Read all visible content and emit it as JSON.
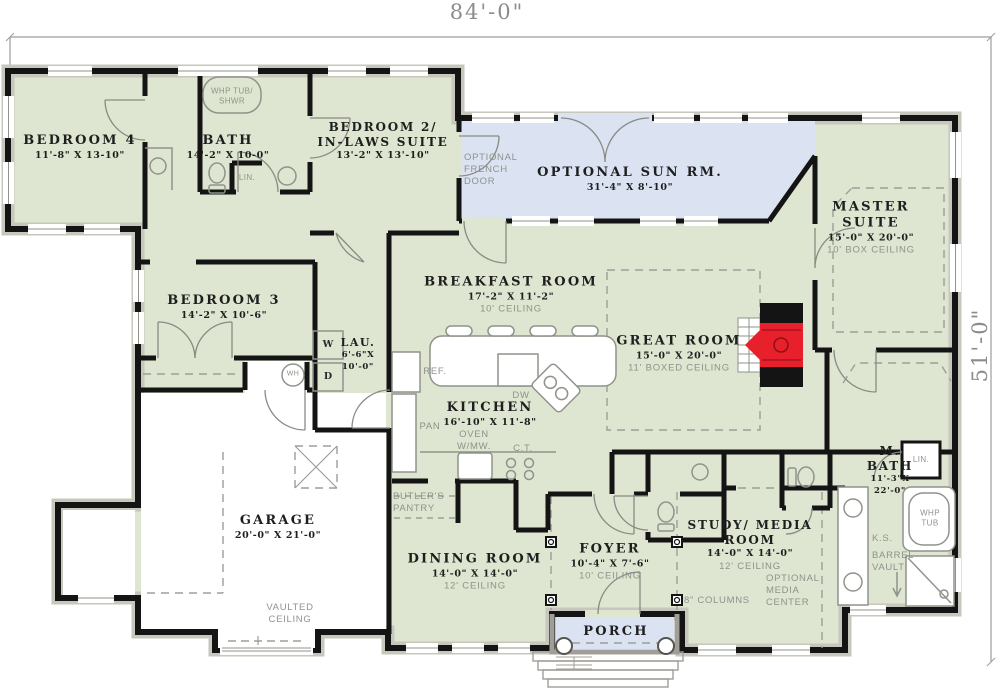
{
  "plan": {
    "dim_top": "84'-0\"",
    "dim_right": "51'-0\"",
    "rooms": {
      "bedroom4": {
        "name": "BEDROOM 4",
        "dims": "11'-8\" X 13-10\""
      },
      "bath": {
        "name": "BATH",
        "dims": "14'-2\" X 10-0\""
      },
      "bedroom2": {
        "name1": "BEDROOM 2/",
        "name2": "IN-LAWS SUITE",
        "dims": "13'-2\" X 13'-10\""
      },
      "sunroom": {
        "name": "OPTIONAL SUN RM.",
        "dims": "31'-4\" X 8'-10\""
      },
      "master": {
        "name1": "MASTER",
        "name2": "SUITE",
        "dims": "15'-0\" X 20'-0\"",
        "ceiling": "10' BOX CEILING"
      },
      "breakfast": {
        "name": "BREAKFAST ROOM",
        "dims": "17'-2\" X 11'-2\"",
        "ceiling": "10' CEILING"
      },
      "greatroom": {
        "name": "GREAT ROOM",
        "dims": "15'-0\" X 20'-0\"",
        "ceiling": "11' BOXED CEILING"
      },
      "bedroom3": {
        "name": "BEDROOM 3",
        "dims": "14'-2\" X 10'-6\""
      },
      "laundry": {
        "name": "LAU.",
        "dims1": "6'-6\"X",
        "dims2": "10'-0\""
      },
      "kitchen": {
        "name": "KITCHEN",
        "dims": "16'-10\" X 11'-8\""
      },
      "garage": {
        "name": "GARAGE",
        "dims": "20'-0\" X 21'-0\""
      },
      "dining": {
        "name": "DINING ROOM",
        "dims": "14'-0\" X 14'-0\"",
        "ceiling": "12' CEILING"
      },
      "foyer": {
        "name": "FOYER",
        "dims": "10'-4\" X 7'-6\"",
        "ceiling": "10' CEILING"
      },
      "study": {
        "name1": "STUDY/ MEDIA",
        "name2": "ROOM",
        "dims": "14'-0\" X 14'-0\"",
        "ceiling": "12' CEILING"
      },
      "mbath": {
        "name1": "M.",
        "name2": "BATH",
        "dims1": "11'-3\"X",
        "dims2": "22'-0\""
      },
      "porch": {
        "name": "PORCH"
      }
    },
    "labels": {
      "whp_shwr1": "WHP TUB/",
      "whp_shwr2": "SHWR",
      "lin_bath": "LIN.",
      "french1": "OPTIONAL",
      "french2": "FRENCH",
      "french3": "DOOR",
      "ref": "REF.",
      "pan": "PAN",
      "dw": "DW",
      "oven1": "OVEN",
      "oven2": "W/MW.",
      "ct": "C.T.",
      "butlers1": "BUTLER'S",
      "butlers2": "PANTRY",
      "vaulted1": "VAULTED",
      "vaulted2": "CEILING",
      "washer": "W",
      "dryer": "D",
      "water_heater": "WH",
      "columns": "8\" COLUMNS",
      "media1": "OPTIONAL",
      "media2": "MEDIA",
      "media3": "CENTER",
      "ks": "K.S.",
      "barrel1": "BARREL",
      "barrel2": "VAULT",
      "whp_tub1": "WHP",
      "whp_tub2": "TUB",
      "lin_master": "LIN."
    },
    "colors": {
      "floor": "#dee5d0",
      "optional_area": "#dbe3f2",
      "wall": "#141414",
      "fireplace": "#e8202c",
      "annotation": "#8e938b"
    }
  }
}
